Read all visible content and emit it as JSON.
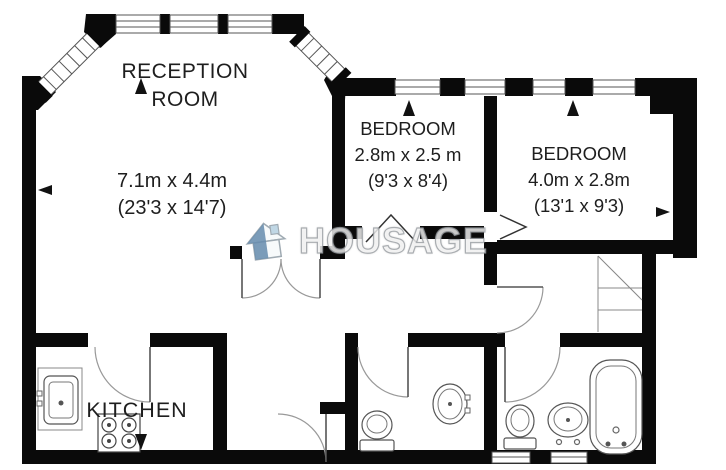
{
  "watermark": {
    "text": "HOUSAGE"
  },
  "rooms": {
    "reception": {
      "name_line1": "RECEPTION",
      "name_line2": "ROOM",
      "dim_metric": "7.1m x 4.4m",
      "dim_imperial": "(23'3 x 14'7)"
    },
    "bedroom1": {
      "name": "BEDROOM",
      "dim_metric": "2.8m x 2.5 m",
      "dim_imperial": "(9'3 x 8'4)"
    },
    "bedroom2": {
      "name": "BEDROOM",
      "dim_metric": "4.0m x 2.8m",
      "dim_imperial": "(13'1 x 9'3)"
    },
    "kitchen": {
      "name": "KITCHEN"
    }
  },
  "colors": {
    "wall": "#0a0a0a",
    "background": "#ffffff",
    "label_text": "#1e1e1e",
    "fixture_line": "#55585c",
    "watermark_text": "#ffffff",
    "watermark_outline": "#9aa0a6",
    "watermark_logo_blue": "#5b84a8",
    "watermark_logo_light_blue": "#bcd4e4"
  }
}
